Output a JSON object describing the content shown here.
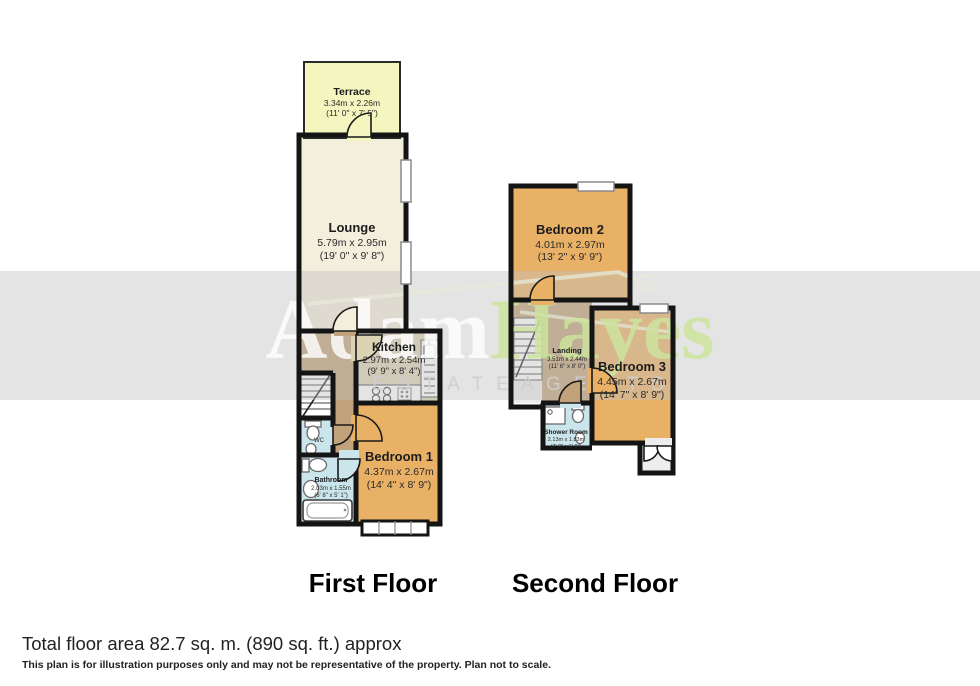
{
  "watermark": {
    "brand_first": "Adam",
    "brand_second": "Hayes",
    "tagline": "E S T A T E     A G E N T S"
  },
  "floors": {
    "first": {
      "label": "First Floor",
      "rooms": {
        "terrace": {
          "name": "Terrace",
          "metric": "3.34m x 2.26m",
          "imperial": "(11' 0\" x 7' 5\")"
        },
        "lounge": {
          "name": "Lounge",
          "metric": "5.79m x 2.95m",
          "imperial": "(19' 0\" x 9' 8\")"
        },
        "kitchen": {
          "name": "Kitchen",
          "metric": "2.97m x 2.54m",
          "imperial": "(9' 9\" x 8' 4\")"
        },
        "bedroom1": {
          "name": "Bedroom 1",
          "metric": "4.37m x 2.67m",
          "imperial": "(14' 4\" x 8' 9\")"
        },
        "bathroom": {
          "name": "Bathroom",
          "metric": "2.03m x 1.55m",
          "imperial": "(6' 8\" x 5' 1\")"
        },
        "wc": {
          "name": "WC"
        }
      }
    },
    "second": {
      "label": "Second Floor",
      "rooms": {
        "bedroom2": {
          "name": "Bedroom 2",
          "metric": "4.01m x 2.97m",
          "imperial": "(13' 2\" x 9' 9\")"
        },
        "landing": {
          "name": "Landing",
          "metric": "3.51m x 2.44m",
          "imperial": "(11' 6\" x 8' 0\")"
        },
        "bedroom3": {
          "name": "Bedroom 3",
          "metric": "4.45m x 2.67m",
          "imperial": "(14' 7\" x 8' 9\")"
        },
        "shower": {
          "name": "Shower Room",
          "metric": "2.13m x 1.83m",
          "imperial": "(7' 0\" x 6' 0\")"
        }
      }
    }
  },
  "footer": {
    "total_area": "Total floor area 82.7 sq. m. (890 sq. ft.) approx",
    "disclaimer": "This plan is for illustration purposes only and may not be representative of the property. Plan not to scale."
  },
  "colors": {
    "wall": "#141414",
    "terrace": "#f4f6c0",
    "lounge": "#f4eedc",
    "kitchen": "#dcd3b4",
    "hall_tan": "#c1a27b",
    "bedroom": "#e8b166",
    "wet_room_blue": "#cae6ec",
    "watermark_green": "#cde49e",
    "band_gray": "#bfbfbf"
  }
}
